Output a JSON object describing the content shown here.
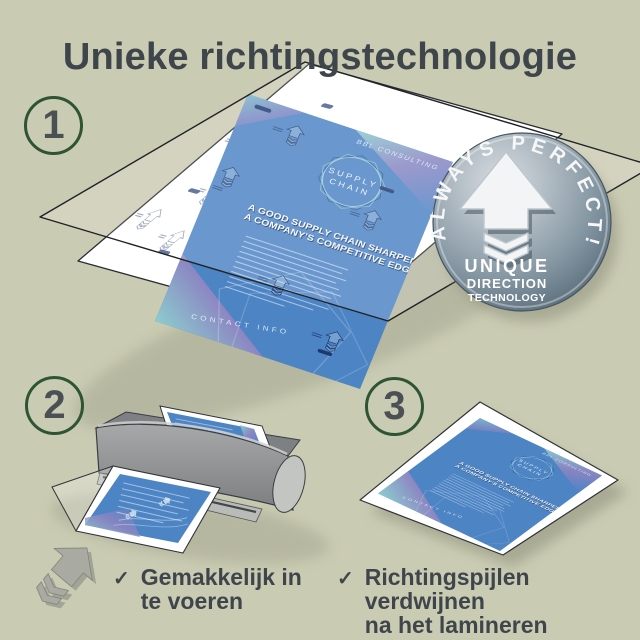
{
  "title": "Unieke richtingstechnologie",
  "step_numbers": {
    "s1": "1",
    "s2": "2",
    "s3": "3"
  },
  "badge": {
    "arc_text": "ALWAYS PERFECT!",
    "line1": "UNIQUE",
    "line2": "DIRECTION",
    "line3": "TECHNOLOGY"
  },
  "flyer": {
    "brand": "BBL CONSULTING",
    "logo_top": "SUPPLY",
    "logo_bottom": "CHAIN",
    "headline1": "A GOOD SUPPLY CHAIN SHARPENS",
    "headline2": "A COMPANY'S COMPETITIVE EDGE.",
    "footer": "CONTACT INFO"
  },
  "captions": {
    "check": "✓",
    "cap1_line1": "Gemakkelijk in",
    "cap1_line2": "te voeren",
    "cap2_line1": "Richtingspijlen verdwijnen",
    "cap2_line2": "na het lamineren"
  },
  "colors": {
    "background": "#cacbb3",
    "text": "#3f464b",
    "circle_ring": "#2d5433",
    "flyer_blue": "#4c84c4",
    "badge_gray": "#8a9aa6",
    "laminator_gray": "#8f9193",
    "pouch_arrow_gray": "#a9aba3",
    "print_navy": "#1d3a6e"
  }
}
